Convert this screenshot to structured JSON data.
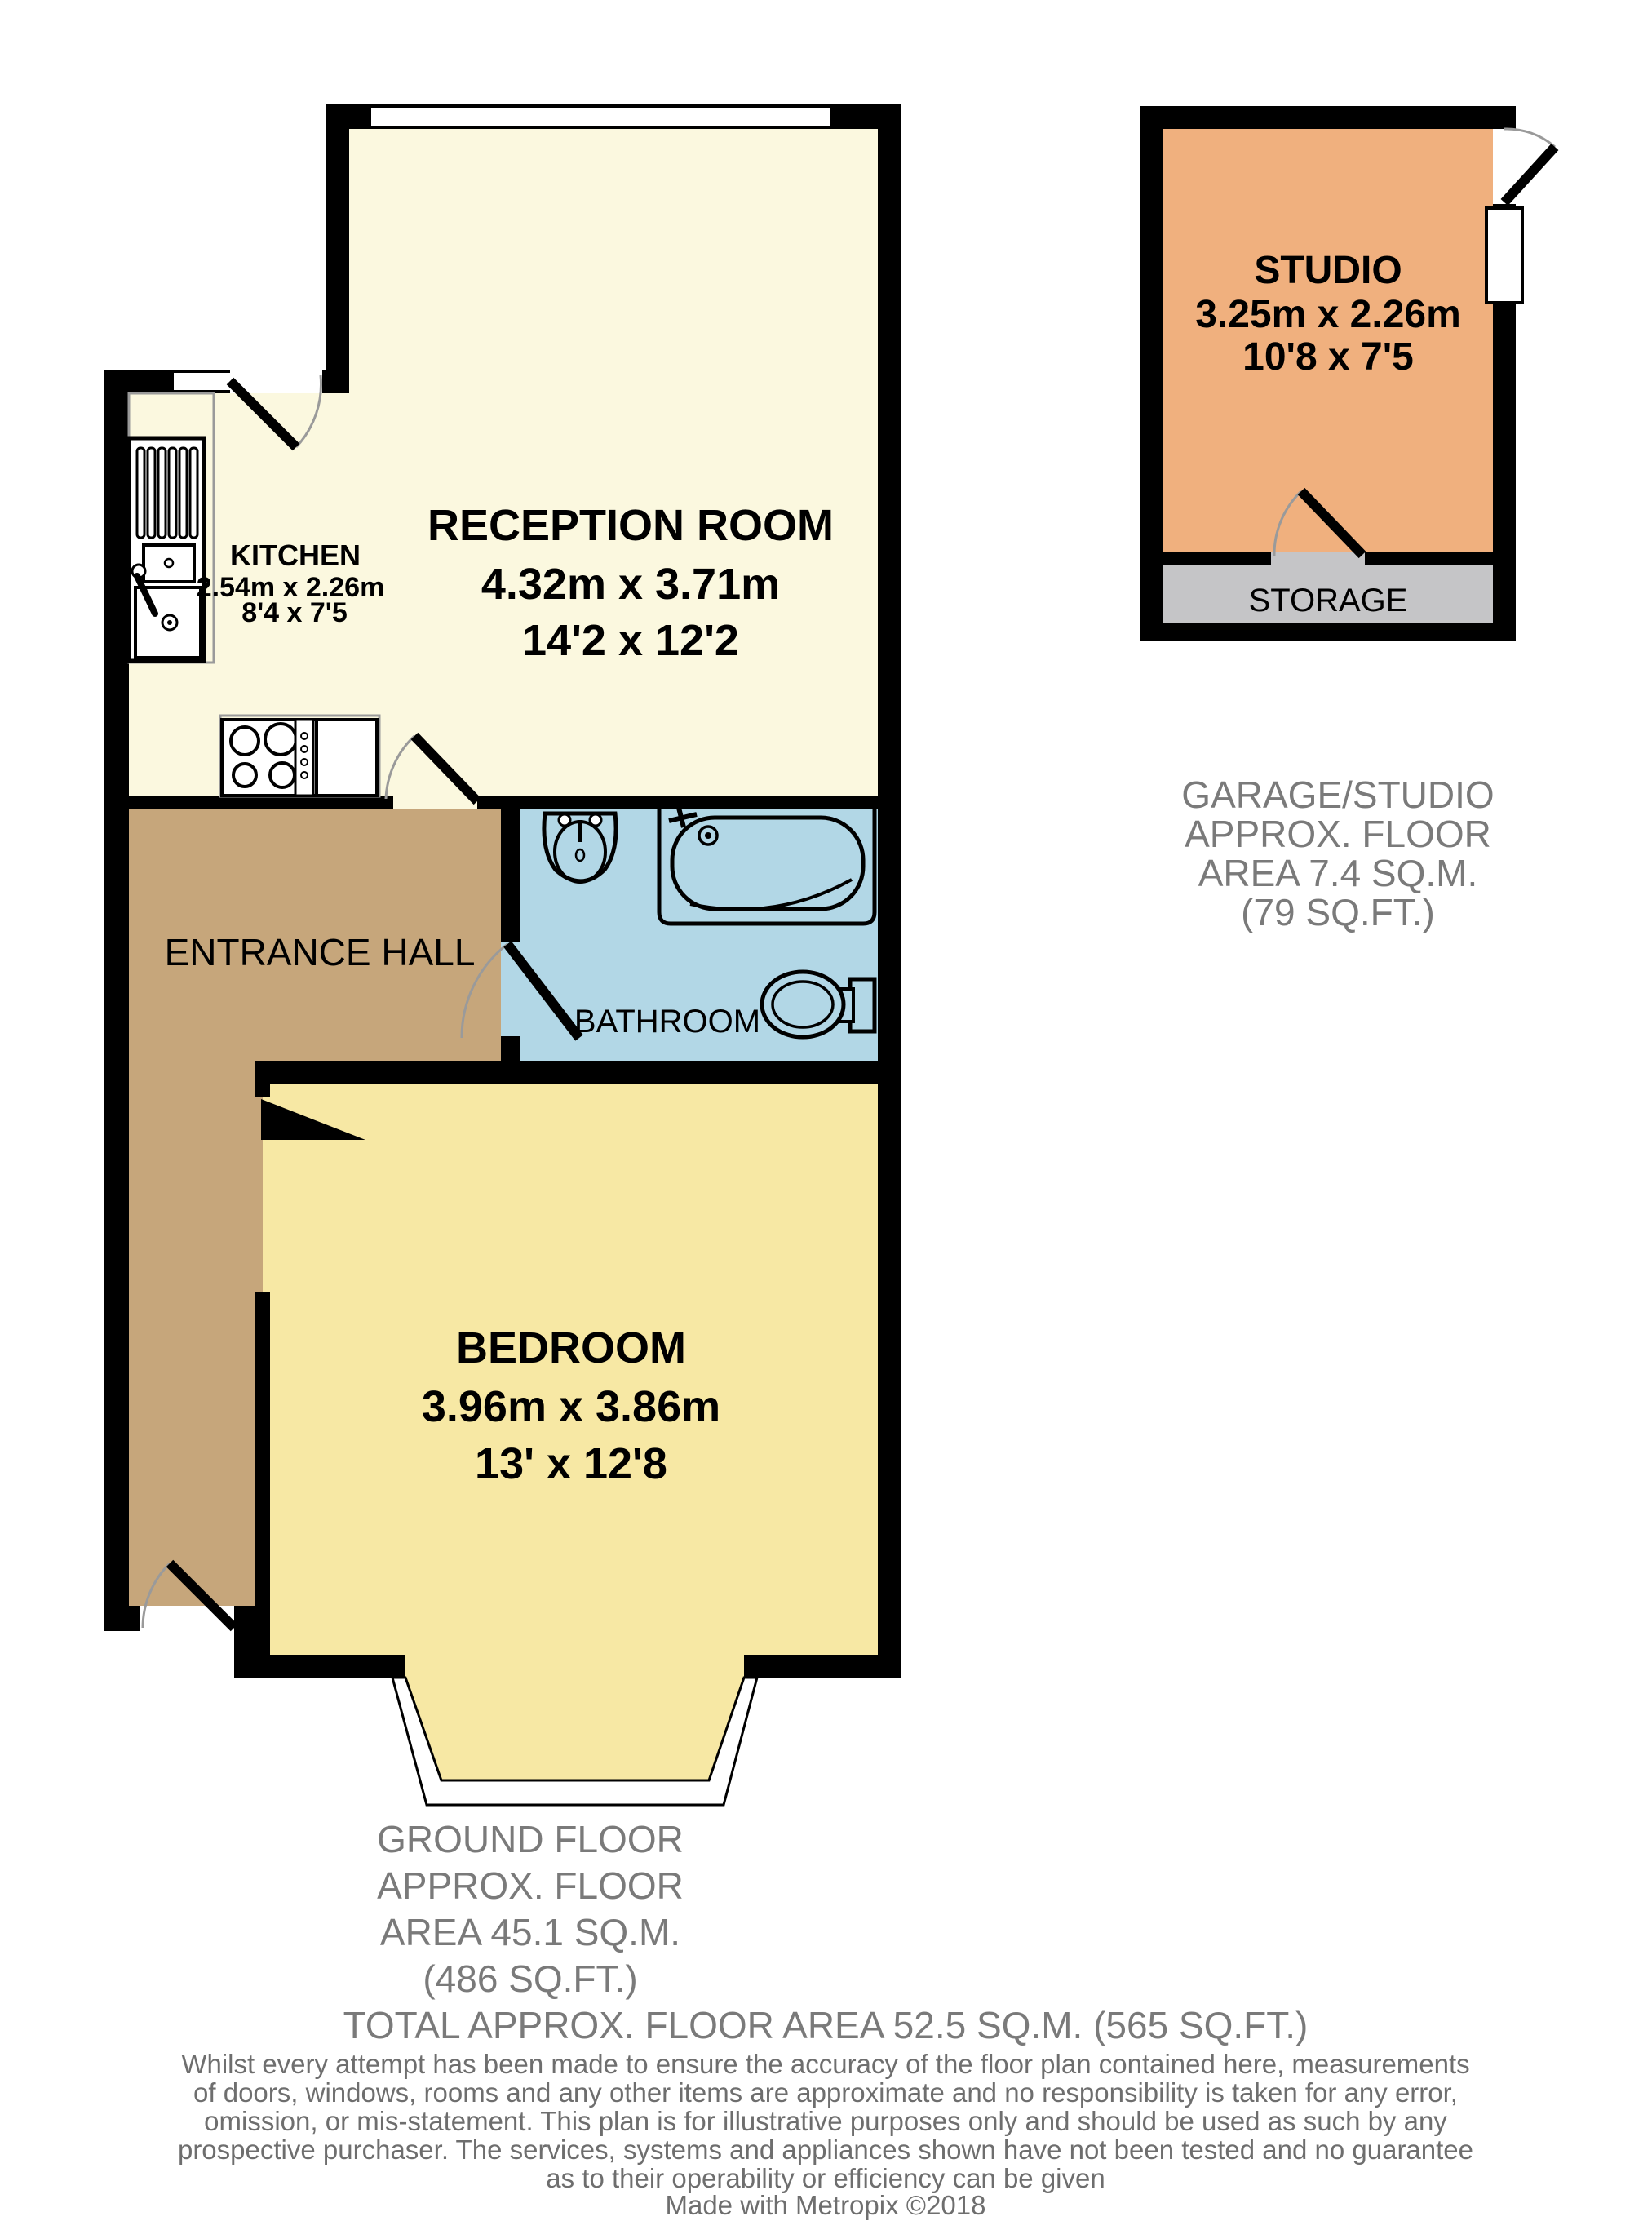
{
  "floorplan": {
    "rooms": {
      "reception": {
        "label": "RECEPTION ROOM",
        "metric": "4.32m x 3.71m",
        "imperial": "14'2 x 12'2"
      },
      "kitchen": {
        "label": "KITCHEN",
        "metric": "2.54m x 2.26m",
        "imperial": "8'4 x 7'5"
      },
      "entrance_hall": {
        "label": "ENTRANCE HALL"
      },
      "bathroom": {
        "label": "BATHROOM"
      },
      "bedroom": {
        "label": "BEDROOM",
        "metric": "3.96m x 3.86m",
        "imperial": "13' x 12'8"
      },
      "studio": {
        "label": "STUDIO",
        "metric": "3.25m x 2.26m",
        "imperial": "10'8 x 7'5"
      },
      "storage": {
        "label": "STORAGE"
      }
    },
    "captions": {
      "garage": [
        "GARAGE/STUDIO",
        "APPROX. FLOOR",
        "AREA 7.4 SQ.M.",
        "(79 SQ.FT.)"
      ],
      "ground": [
        "GROUND FLOOR",
        "APPROX. FLOOR",
        "AREA 45.1 SQ.M.",
        "(486 SQ.FT.)"
      ],
      "total": "TOTAL APPROX. FLOOR AREA 52.5 SQ.M. (565 SQ.FT.)"
    },
    "disclaimer": [
      "Whilst every attempt has been made to ensure the accuracy of the floor plan contained here, measurements",
      "of doors, windows, rooms and any other items are approximate and no responsibility is taken for any error,",
      "omission, or mis-statement. This plan is for illustrative purposes only and should be used as such by any",
      "prospective purchaser. The services, systems and appliances shown have not been tested and no guarantee",
      "as to their operability or efficiency can be given"
    ],
    "credit": "Made with Metropix ©2018",
    "colors": {
      "floor_cream": "#FBF8DF",
      "floor_yellow": "#F7E8A4",
      "floor_tan": "#C6A67B",
      "floor_blue": "#B2D7E6",
      "floor_orange": "#F0B07E",
      "floor_gray": "#C5C5C7",
      "wall": "#000000",
      "caption_gray": "#7A7A7A"
    }
  }
}
